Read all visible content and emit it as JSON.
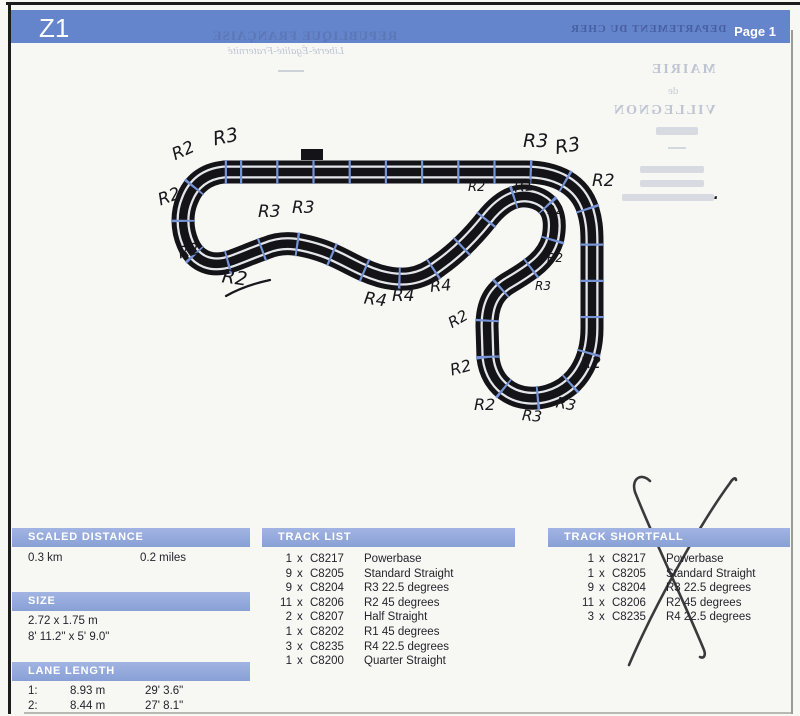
{
  "page": {
    "title": "Z1",
    "page_label": "Page 1"
  },
  "watermark": {
    "top_line1": "REPUBLIQUE FRANÇAISE",
    "top_line2": "Liberté-Égalité-Fraternité",
    "header_right": "DEPARTEMENT DU CHER",
    "right_line1": "MAIRIE",
    "right_line2": "de",
    "right_line3": "VILLEGNON"
  },
  "panels": {
    "times_label": "x",
    "scaled_distance": {
      "title": "SCALED DISTANCE",
      "km": "0.3 km",
      "miles": "0.2 miles"
    },
    "size": {
      "title": "SIZE",
      "metric": "2.72 x 1.75 m",
      "imperial": "8' 11.2\" x 5' 9.0\""
    },
    "lane_length": {
      "title": "LANE LENGTH",
      "rows": [
        {
          "lane": "1:",
          "metric": "8.93 m",
          "imperial": "29' 3.6\""
        },
        {
          "lane": "2:",
          "metric": "8.44 m",
          "imperial": "27' 8.1\""
        }
      ]
    },
    "track_list": {
      "title": "TRACK LIST",
      "rows": [
        {
          "qty": "1",
          "code": "C8217",
          "name": "Powerbase"
        },
        {
          "qty": "9",
          "code": "C8205",
          "name": "Standard Straight"
        },
        {
          "qty": "9",
          "code": "C8204",
          "name": "R3 22.5 degrees"
        },
        {
          "qty": "11",
          "code": "C8206",
          "name": "R2 45 degrees"
        },
        {
          "qty": "2",
          "code": "C8207",
          "name": "Half Straight"
        },
        {
          "qty": "1",
          "code": "C8202",
          "name": "R1 45 degrees"
        },
        {
          "qty": "3",
          "code": "C8235",
          "name": "R4 22.5 degrees"
        },
        {
          "qty": "1",
          "code": "C8200",
          "name": "Quarter Straight"
        }
      ]
    },
    "track_shortfall": {
      "title": "TRACK SHORTFALL",
      "rows": [
        {
          "qty": "1",
          "code": "C8217",
          "name": "Powerbase"
        },
        {
          "qty": "1",
          "code": "C8205",
          "name": "Standard Straight"
        },
        {
          "qty": "9",
          "code": "C8204",
          "name": "R3 22.5 degrees"
        },
        {
          "qty": "11",
          "code": "C8206",
          "name": "R2 45 degrees"
        },
        {
          "qty": "3",
          "code": "C8235",
          "name": "R4 22.5 degrees"
        }
      ]
    }
  },
  "annotations": [
    {
      "text": "R2",
      "x": 172,
      "y": 141,
      "rot": -25,
      "size": 17
    },
    {
      "text": "R3",
      "x": 213,
      "y": 126,
      "rot": -12,
      "size": 19
    },
    {
      "text": "R2",
      "x": 158,
      "y": 187,
      "rot": -20,
      "size": 17
    },
    {
      "text": "R2",
      "x": 178,
      "y": 241,
      "rot": -15,
      "size": 16
    },
    {
      "text": "R2",
      "x": 222,
      "y": 267,
      "rot": 8,
      "size": 19
    },
    {
      "text": "R3",
      "x": 258,
      "y": 202,
      "rot": 0,
      "size": 17
    },
    {
      "text": "R3",
      "x": 292,
      "y": 198,
      "rot": 0,
      "size": 17
    },
    {
      "text": "R4",
      "x": 364,
      "y": 290,
      "rot": 8,
      "size": 17
    },
    {
      "text": "R4",
      "x": 392,
      "y": 286,
      "rot": 0,
      "size": 17
    },
    {
      "text": "R4",
      "x": 430,
      "y": 276,
      "rot": -5,
      "size": 16
    },
    {
      "text": "R2",
      "x": 468,
      "y": 180,
      "rot": 0,
      "size": 13
    },
    {
      "text": "R1",
      "x": 514,
      "y": 177,
      "rot": -5,
      "size": 15
    },
    {
      "text": "R3",
      "x": 523,
      "y": 130,
      "rot": 0,
      "size": 19
    },
    {
      "text": "R3",
      "x": 555,
      "y": 135,
      "rot": -10,
      "size": 19
    },
    {
      "text": "R2",
      "x": 592,
      "y": 171,
      "rot": 0,
      "size": 17
    },
    {
      "text": "R2",
      "x": 547,
      "y": 203,
      "rot": 0,
      "size": 12
    },
    {
      "text": "R2",
      "x": 547,
      "y": 251,
      "rot": 0,
      "size": 12
    },
    {
      "text": "R3",
      "x": 535,
      "y": 279,
      "rot": 0,
      "size": 12
    },
    {
      "text": "R2",
      "x": 448,
      "y": 310,
      "rot": -30,
      "size": 15
    },
    {
      "text": "R2",
      "x": 450,
      "y": 358,
      "rot": -15,
      "size": 16
    },
    {
      "text": "R2",
      "x": 474,
      "y": 395,
      "rot": 0,
      "size": 16
    },
    {
      "text": "R3",
      "x": 522,
      "y": 407,
      "rot": 5,
      "size": 15
    },
    {
      "text": "R3",
      "x": 556,
      "y": 395,
      "rot": 10,
      "size": 15
    },
    {
      "text": "R2",
      "x": 580,
      "y": 353,
      "rot": 0,
      "size": 16
    },
    {
      "text": ".",
      "x": 713,
      "y": 180,
      "rot": 0,
      "size": 22
    }
  ],
  "colors": {
    "header_blue": "#6484cc",
    "panel_bar_blue": "#8aa0d6",
    "joint_blue": "#7693d6",
    "track_black": "#141418",
    "slot_white": "#e4e6ea",
    "ink": "#1d1d22"
  }
}
